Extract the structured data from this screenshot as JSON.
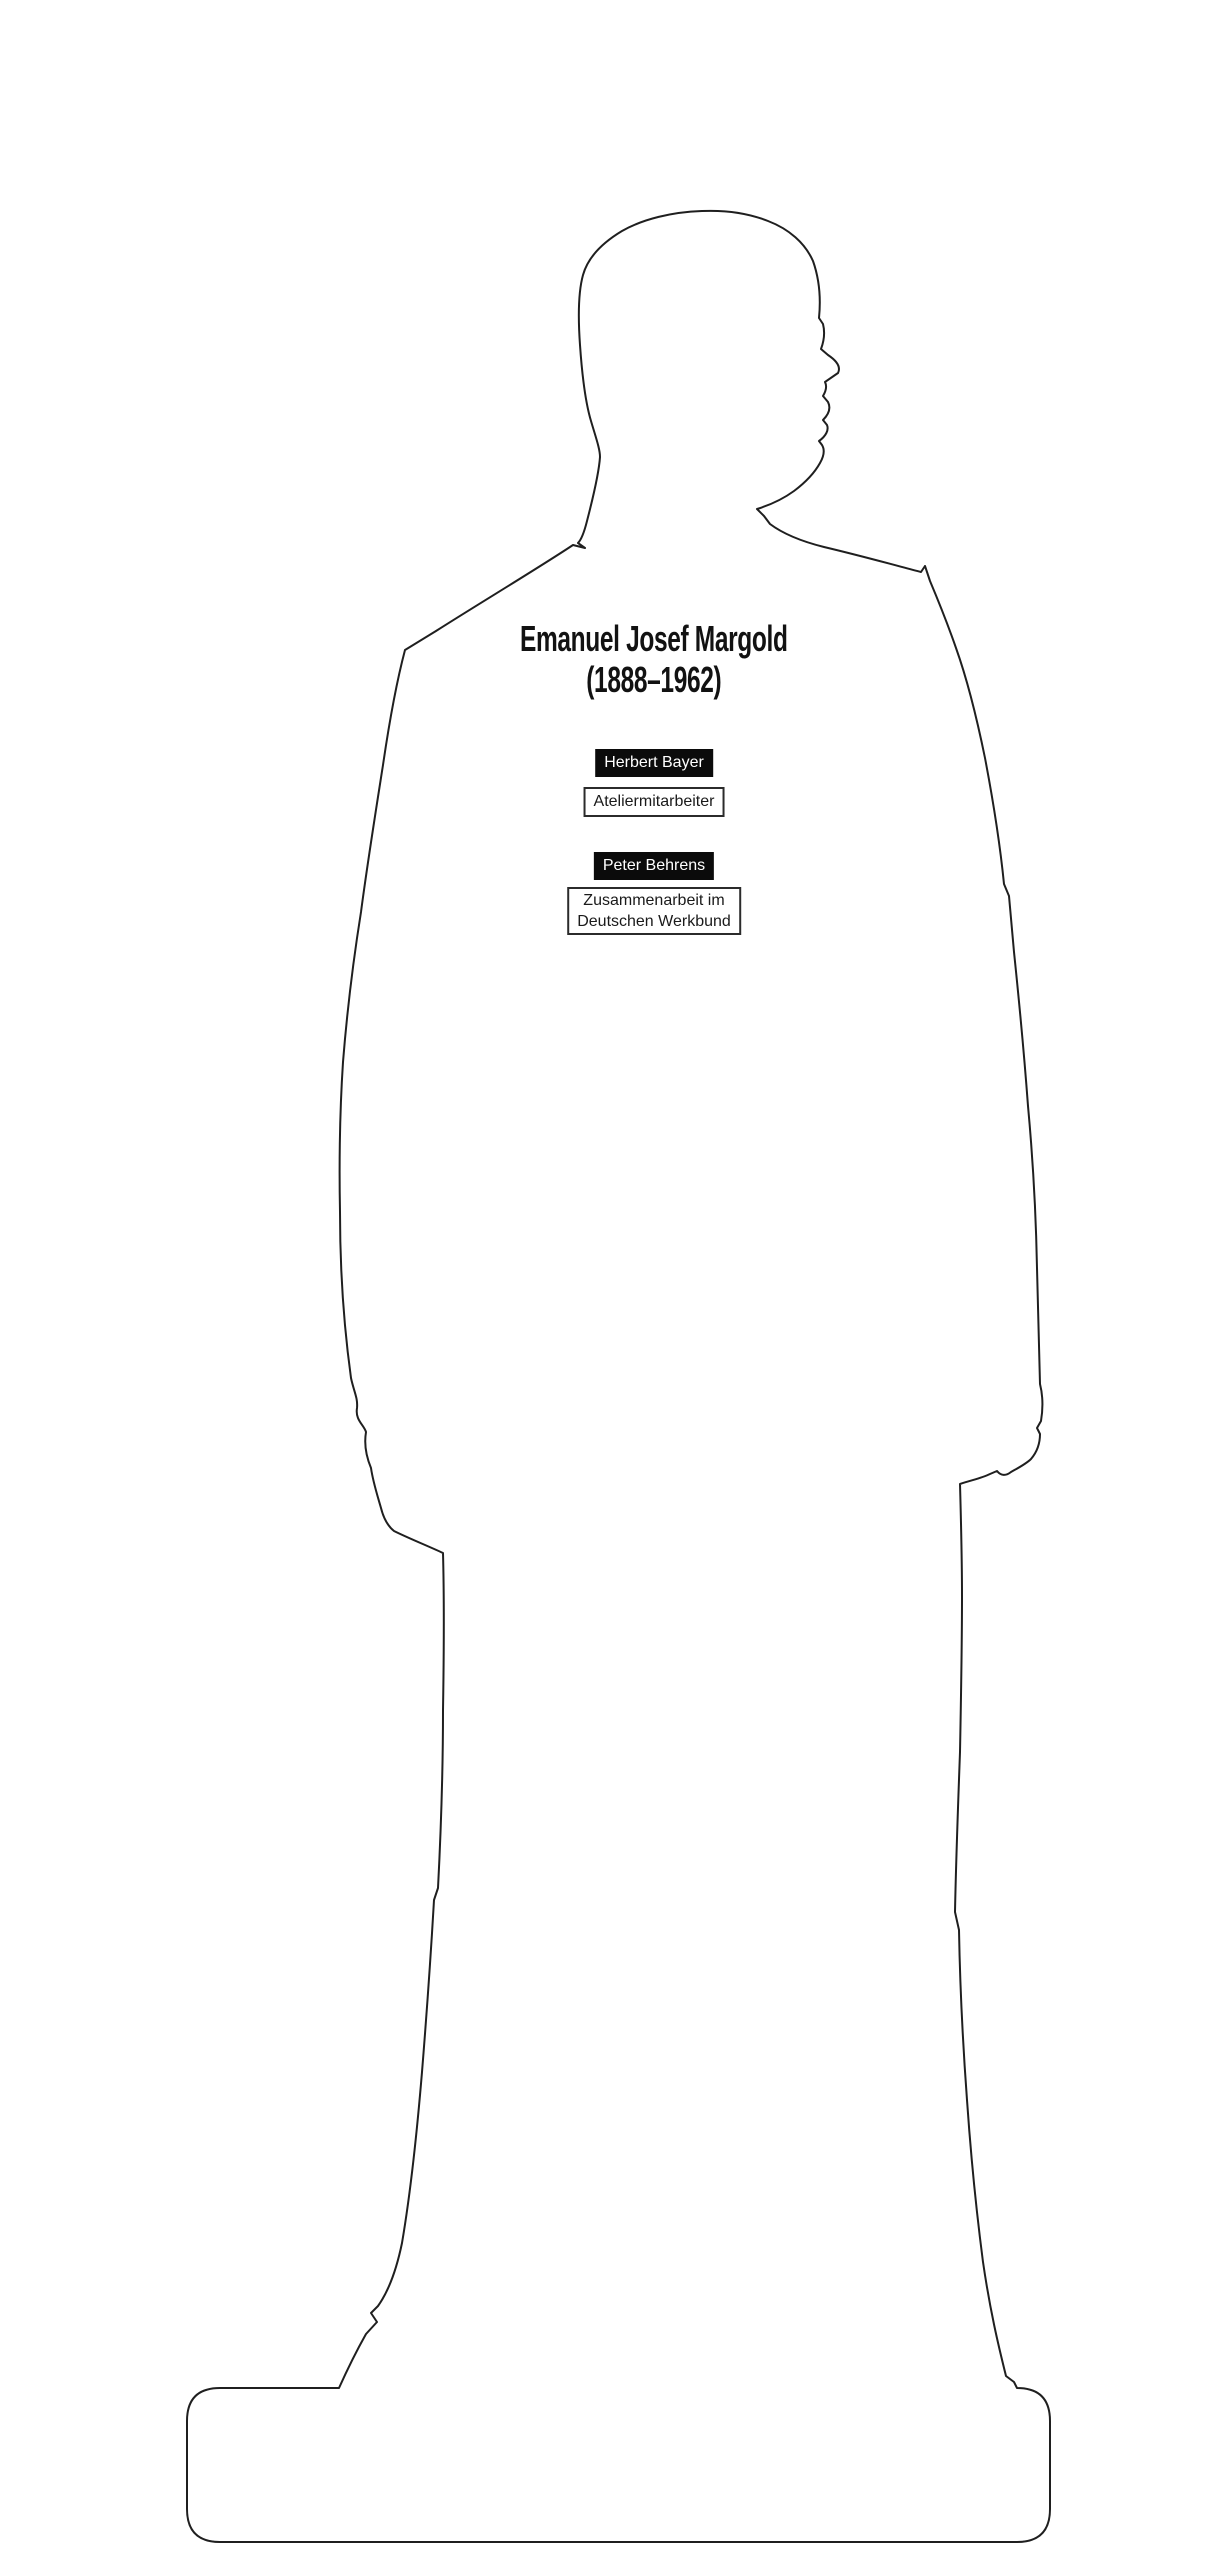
{
  "person": {
    "name": "Emanuel Josef Margold",
    "years": "(1888–1962)"
  },
  "connections": [
    {
      "person": "Herbert Bayer",
      "relation": "Ateliermitarbeiter"
    },
    {
      "person": "Peter Behrens",
      "relation": "Zusammenarbeit im\nDeutschen Werkbund"
    }
  ],
  "silhouette": {
    "figure": "standing-man-profile-facing-right-on-plinth",
    "outline_color": "#1f1f1f",
    "fill_color": "#ffffff"
  },
  "colors": {
    "background": "#ffffff",
    "person_tag_bg": "#0b0b0b",
    "person_tag_text": "#ffffff",
    "relation_tag_border": "#2b2b2b",
    "title_text": "#121212"
  }
}
